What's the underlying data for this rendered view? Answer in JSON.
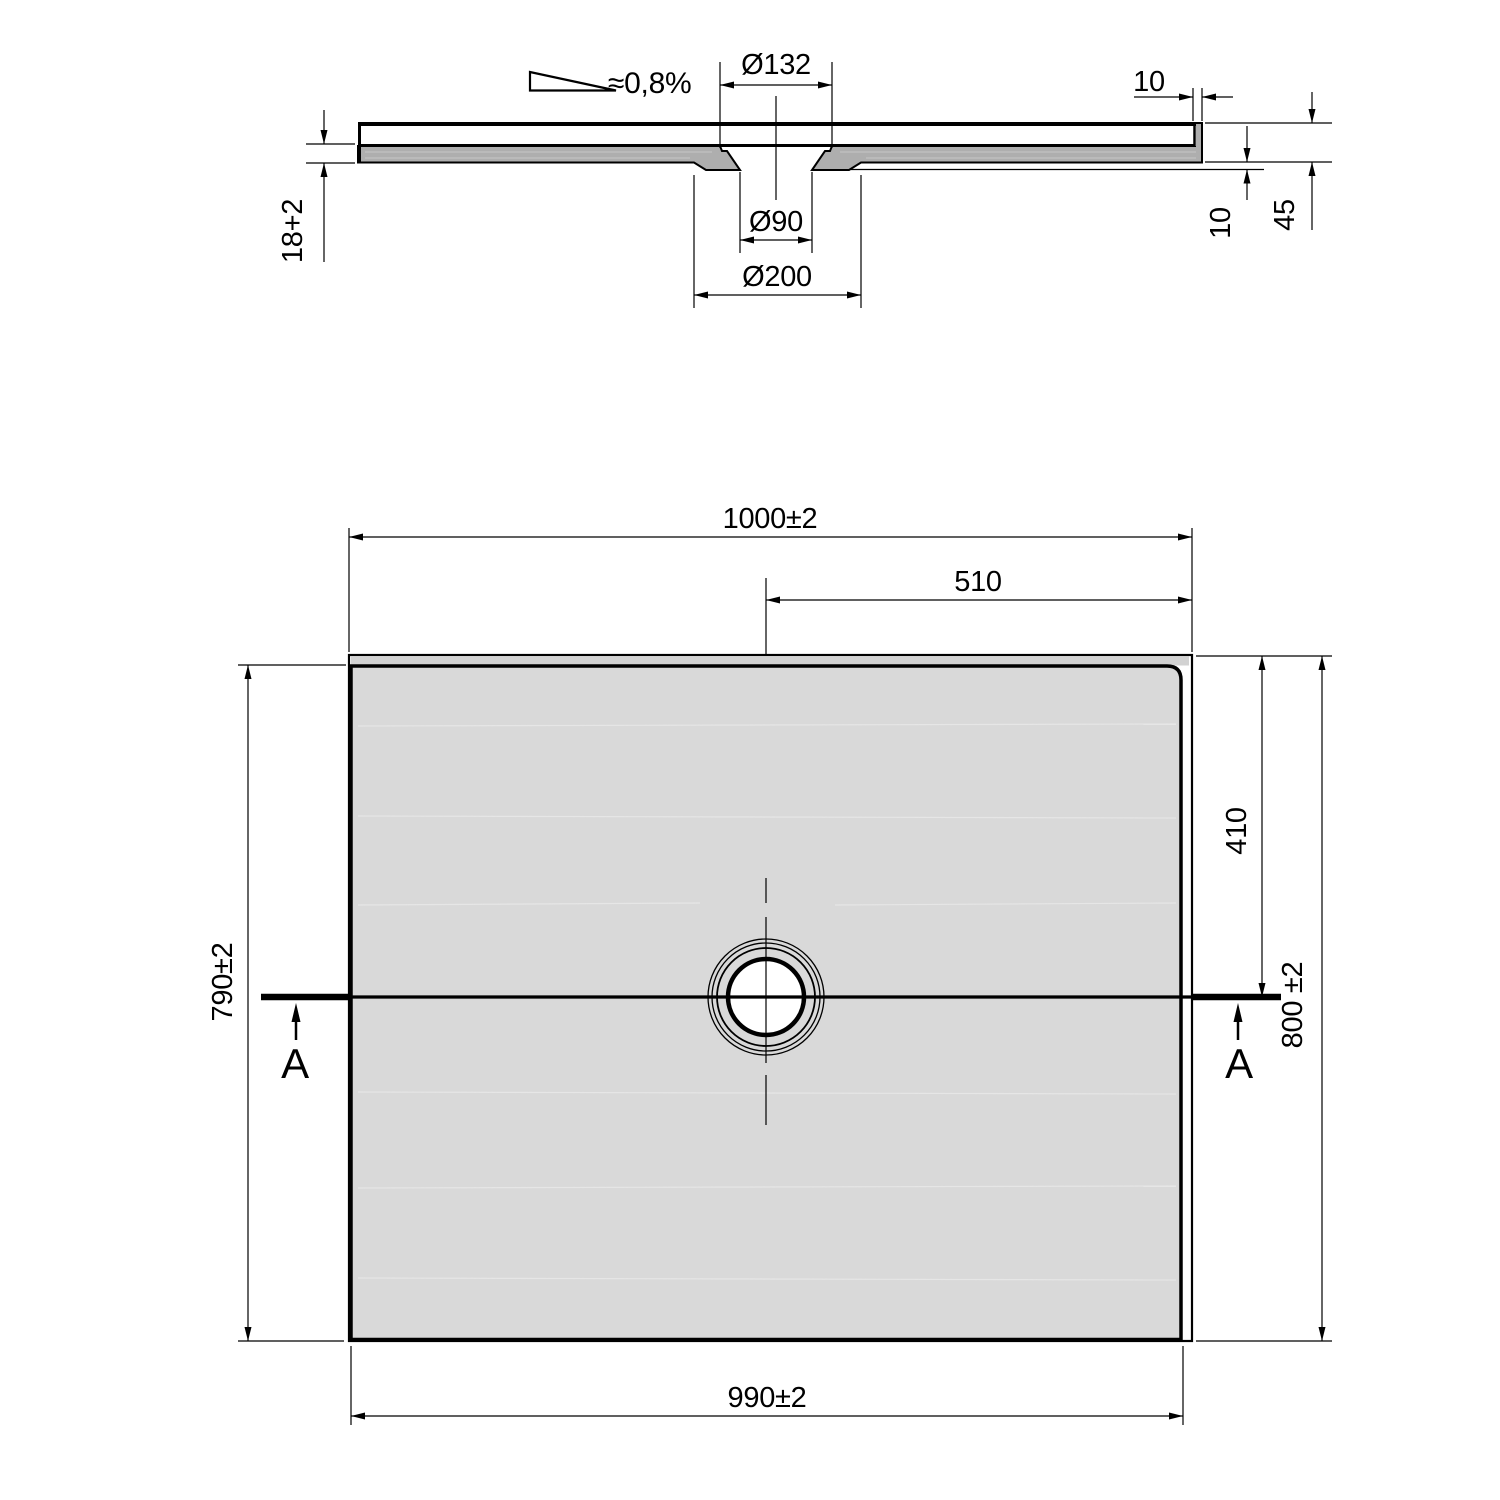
{
  "drawing": {
    "title": "Shower tray technical drawing",
    "section_view": {
      "slope_label": "≈0,8%",
      "top_recess_dia": "Ø132",
      "outlet_dia": "Ø90",
      "boss_dia": "Ø200",
      "lip_width": "10",
      "sheet_thickness": "18+2",
      "underside_gap": "10",
      "edge_height": "45"
    },
    "plan_view": {
      "overall_width": "1000±2",
      "drain_offset_right": "510",
      "body_depth": "790±2",
      "drain_offset_top": "410",
      "overall_depth": "800 ±2",
      "body_width": "990±2",
      "cut_label_left": "A",
      "cut_label_right": "A"
    },
    "colors": {
      "line": "#000000",
      "section_material": "#aeaeae",
      "plan_surface": "#d9d9d9",
      "lip_strip": "#d2d2d2"
    }
  }
}
